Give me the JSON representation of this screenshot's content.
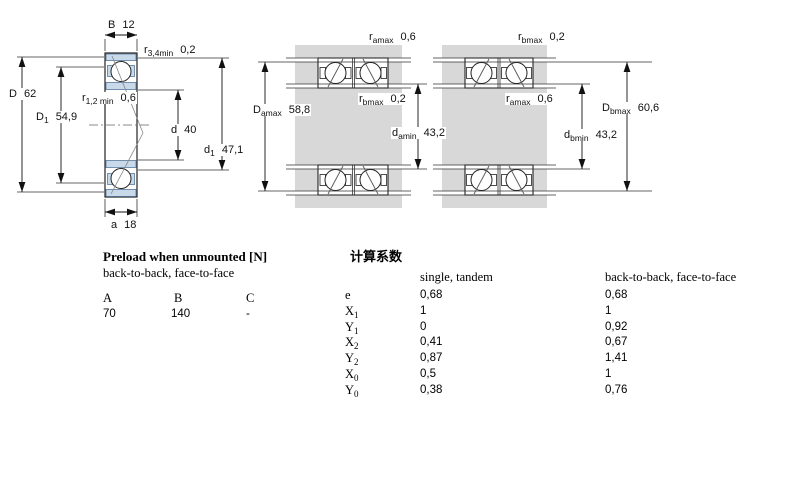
{
  "drawings": {
    "single": {
      "B": {
        "sym": "B",
        "sub": "",
        "val": "12"
      },
      "r34": {
        "sym": "r",
        "sub": "3,4min",
        "val": "0,2"
      },
      "D": {
        "sym": "D",
        "sub": "",
        "val": "62"
      },
      "D1": {
        "sym": "D",
        "sub": "1",
        "val": "54,9"
      },
      "r12": {
        "sym": "r",
        "sub": "1,2 min",
        "val": "0,6"
      },
      "d": {
        "sym": "d",
        "sub": "",
        "val": "40"
      },
      "d1": {
        "sym": "d",
        "sub": "1",
        "val": "47,1"
      },
      "a": {
        "sym": "a",
        "sub": "",
        "val": "18"
      }
    },
    "b2b": {
      "ramax": {
        "sym": "r",
        "sub": "amax",
        "val": "0,6"
      },
      "rbmax": {
        "sym": "r",
        "sub": "bmax",
        "val": "0,2"
      },
      "Damax": {
        "sym": "D",
        "sub": "amax",
        "val": "58,8"
      },
      "damin": {
        "sym": "d",
        "sub": "amin",
        "val": "43,2"
      }
    },
    "f2f": {
      "rbmax": {
        "sym": "r",
        "sub": "bmax",
        "val": "0,2"
      },
      "ramax": {
        "sym": "r",
        "sub": "amax",
        "val": "0,6"
      },
      "Dbmax": {
        "sym": "D",
        "sub": "bmax",
        "val": "60,6"
      },
      "dbmin": {
        "sym": "d",
        "sub": "bmin",
        "val": "43,2"
      }
    }
  },
  "preload": {
    "title": "Preload when unmounted [N]",
    "subtitle": "back-to-back, face-to-face",
    "columns": [
      "A",
      "B",
      "C"
    ],
    "values": [
      "70",
      "140",
      "-"
    ]
  },
  "factors": {
    "title": "计算系数",
    "col_single": "single, tandem",
    "col_paired": "back-to-back, face-to-face",
    "rows": [
      {
        "sym": "e",
        "sub": "",
        "single": "0,68",
        "paired": "0,68"
      },
      {
        "sym": "X",
        "sub": "1",
        "single": "1",
        "paired": "1"
      },
      {
        "sym": "Y",
        "sub": "1",
        "single": "0",
        "paired": "0,92"
      },
      {
        "sym": "X",
        "sub": "2",
        "single": "0,41",
        "paired": "0,67"
      },
      {
        "sym": "Y",
        "sub": "2",
        "single": "0,87",
        "paired": "1,41"
      },
      {
        "sym": "X",
        "sub": "0",
        "single": "0,5",
        "paired": "1"
      },
      {
        "sym": "Y",
        "sub": "0",
        "single": "0,38",
        "paired": "0,76"
      }
    ]
  }
}
